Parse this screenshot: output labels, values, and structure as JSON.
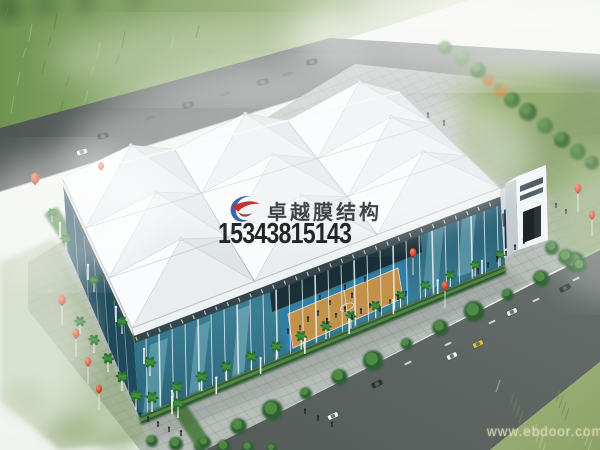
{
  "image": {
    "kind": "architectural aerial rendering",
    "subject": "sports hall with 3x3 white tensile membrane cone roof, glass walls, basketball court inside, palm-lined plaza, roads with cars, red balloon decorations"
  },
  "watermark": {
    "brand": "卓越膜结构",
    "phone": "15343815143",
    "logo": "swoosh-logo",
    "brand_color": "#3f4449",
    "phone_color": "#17191b",
    "logo_blue": "#3a66b0",
    "logo_red": "#c8302e"
  },
  "site_watermark": {
    "text": "www.ebdoor.com",
    "color": "#e0d8aa"
  },
  "palette": {
    "roof_white": "#f3f6f7",
    "glass_teal": "#2e6f85",
    "plaza_gray": "#b7bdb9",
    "road_gray": "#575e5c",
    "grass_green": "#7fa25a",
    "court_tan": "#c2914a",
    "court_blue": "#2e7ea6",
    "balloon_red": "#d8452b",
    "palm_green": "#276b2e"
  }
}
